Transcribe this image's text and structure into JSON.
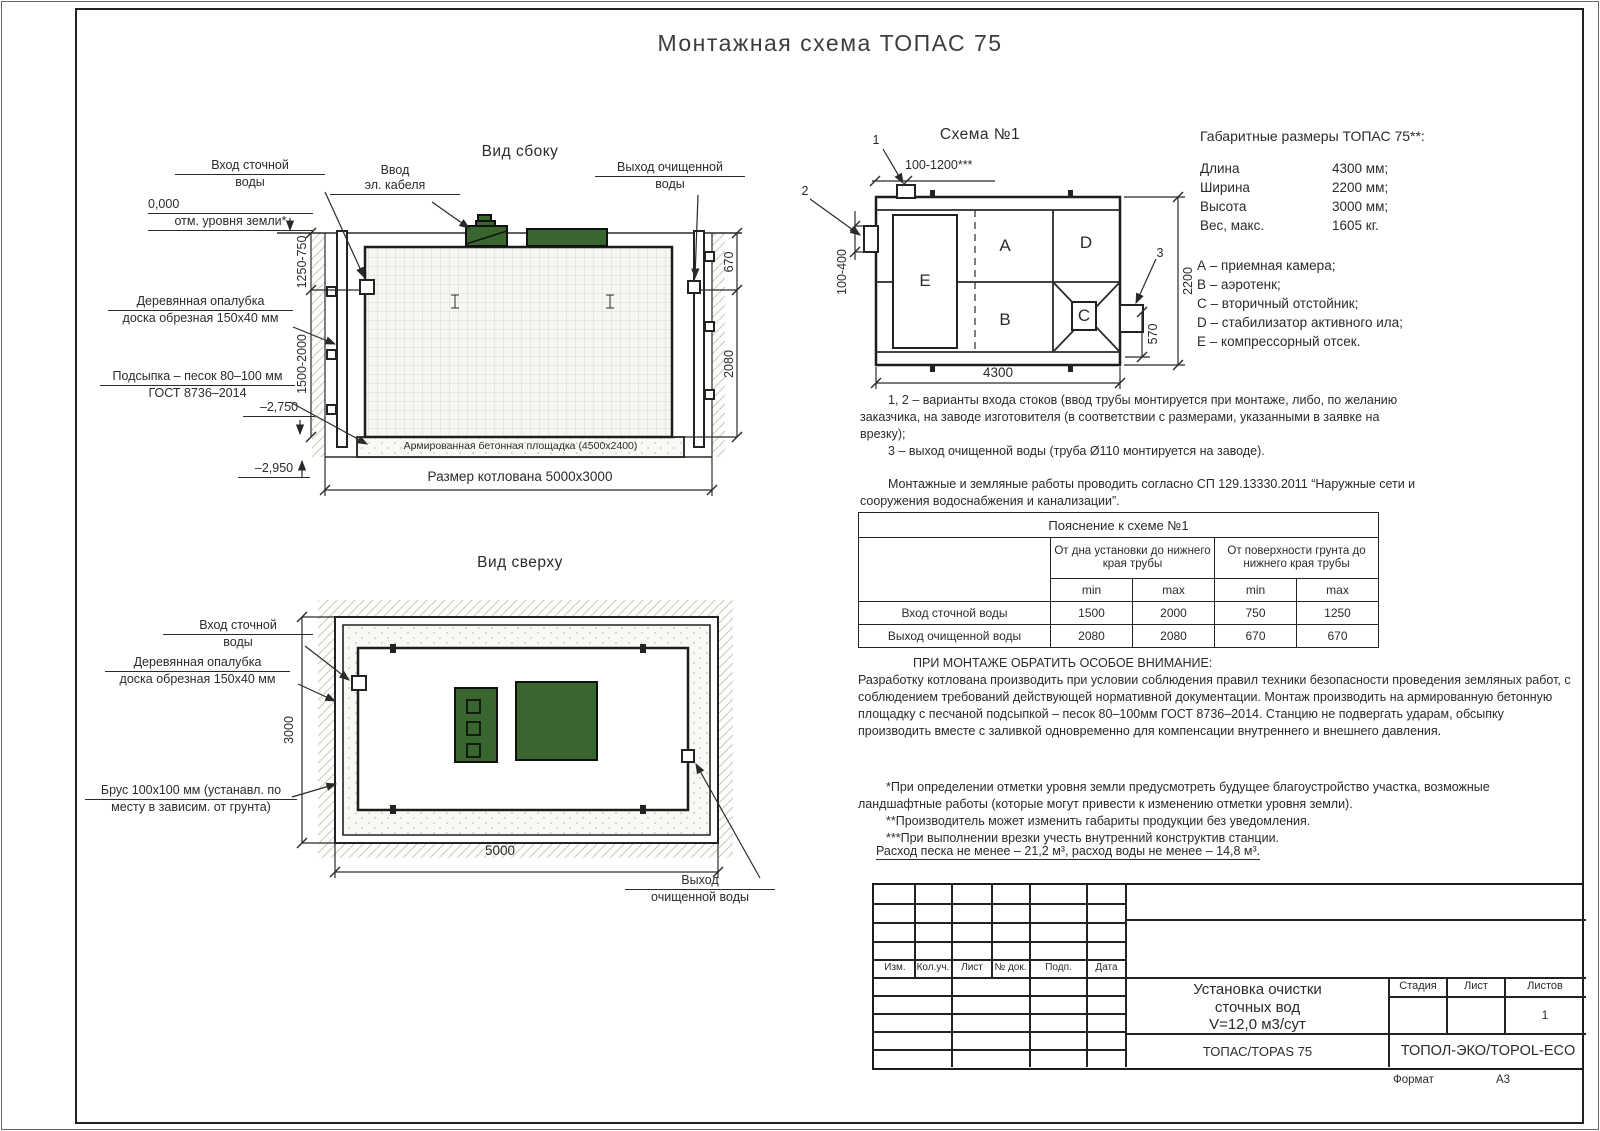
{
  "doc": {
    "title": "Монтажная схема ТОПАС 75"
  },
  "side_view": {
    "title": "Вид сбоку",
    "labels": {
      "inlet_l1": "Вход сточной",
      "inlet_l2": "воды",
      "zero": "0,000",
      "ground": "отм. уровня земли*",
      "cable_l1": "Ввод",
      "cable_l2": "эл. кабеля",
      "outlet_l1": "Выход очищенной",
      "outlet_l2": "воды",
      "formwork_l1": "Деревянная опалубка",
      "formwork_l2": "доска обрезная 150х40 мм",
      "sand_l1": "Подсыпка – песок 80–100 мм",
      "sand_l2": "ГОСТ 8736–2014",
      "mark_2750": "–2,750",
      "mark_2950": "–2,950",
      "pad": "Армированная бетонная площадка (4500х2400)",
      "pit": "Размер котлована 5000х3000"
    },
    "dims": {
      "depth_top": "1250-750",
      "depth_bottom": "1500-2000",
      "outlet_offset": "670",
      "outlet_depth": "2080"
    }
  },
  "top_view": {
    "title": "Вид сверху",
    "labels": {
      "inlet_l1": "Вход сточной",
      "inlet_l2": "воды",
      "formwork_l1": "Деревянная опалубка",
      "formwork_l2": "доска обрезная 150х40 мм",
      "brus_l1": "Брус 100х100 мм (устанавл. по",
      "brus_l2": "месту в зависим. от грунта)",
      "outlet_l1": "Выход",
      "outlet_l2": "очищенной воды"
    },
    "dims": {
      "width": "3000",
      "length": "5000"
    }
  },
  "schema": {
    "title": "Схема №1",
    "callouts": {
      "c1": "1",
      "c2": "2",
      "c3": "3"
    },
    "compartments": {
      "a": "А",
      "b": "В",
      "c": "С",
      "d": "D",
      "e": "Е"
    },
    "dims": {
      "inlet_range": "100-1200***",
      "inlet_depth": "100-400",
      "width": "2200",
      "outlet": "570",
      "length": "4300"
    }
  },
  "specs": {
    "title": "Габаритные размеры ТОПАС 75**:",
    "rows": [
      {
        "label": "Длина",
        "value": "4300 мм;"
      },
      {
        "label": "Ширина",
        "value": "2200 мм;"
      },
      {
        "label": "Высота",
        "value": "3000 мм;"
      },
      {
        "label": "Вес, макс.",
        "value": "1605 кг."
      }
    ],
    "legend": [
      "А – приемная камера;",
      "В – аэротенк;",
      "С – вторичный отстойник;",
      "D – стабилизатор активного ила;",
      "Е – компрессорный отсек."
    ]
  },
  "notes": {
    "variants": "1, 2 – варианты входа  стоков (ввод трубы монтируется при монтаже, либо, по желанию заказчика, на заводе изготовителя (в соответствии с размерами, указанными в заявке на врезку);",
    "outlet": "3 – выход очищенной воды (труба Ø110 монтируется на заводе).",
    "sp": "Монтажные и земляные работы проводить согласно СП 129.13330.2011 “Наружные сети и сооружения водоснабжения и канализации”."
  },
  "explain_table": {
    "title": "Пояснение к схеме №1",
    "group1": "От дна установки до нижнего края трубы",
    "group2": "От поверхности грунта до нижнего края трубы",
    "min": "min",
    "max": "max",
    "rows": [
      {
        "label": "Вход сточной воды",
        "values": [
          "1500",
          "2000",
          "750",
          "1250"
        ]
      },
      {
        "label": "Выход очищенной воды",
        "values": [
          "2080",
          "2080",
          "670",
          "670"
        ]
      }
    ]
  },
  "attention": {
    "title": "ПРИ МОНТАЖЕ ОБРАТИТЬ ОСОБОЕ ВНИМАНИЕ:",
    "body": "Разработку котлована производить при условии соблюдения правил техники безопасности проведения земляных работ, с соблюдением требований действующей нормативной документации.  Монтаж производить на армированную бетонную площадку с песчаной подсыпкой – песок 80–100мм ГОСТ 8736–2014. Станцию не подвергать ударам, обсыпку производить вместе с заливкой одновременно для компенсации внутреннего и внешнего давления.",
    "star1": "*При определении отметки уровня земли предусмотреть будущее благоустройство участка, возможные ландшафтные работы (которые могут привести к изменению отметки уровня земли).",
    "star2": "**Производитель может изменить габариты продукции без уведомления.",
    "star3": "***При выполнении врезки учесть внутренний конструктив станции.",
    "consumption": "Расход песка не менее – 21,2 м³, расход воды не менее – 14,8 м³."
  },
  "title_block": {
    "rev_cols": [
      "Изм.",
      "Кол.уч.",
      "Лист",
      "№ док.",
      "Подп.",
      "Дата"
    ],
    "doc_l1": "Установка очистки",
    "doc_l2": "сточных вод",
    "doc_l3": "V=12,0 м3/сут",
    "model": "ТОПАС/TOPAS 75",
    "brand": "ТОПОЛ-ЭКО/TOPOL-ECO",
    "stage_label": "Стадия",
    "sheet_label": "Лист",
    "sheets_label": "Листов",
    "sheets_value": "1",
    "format_label": "Формат",
    "format_value": "А3"
  }
}
